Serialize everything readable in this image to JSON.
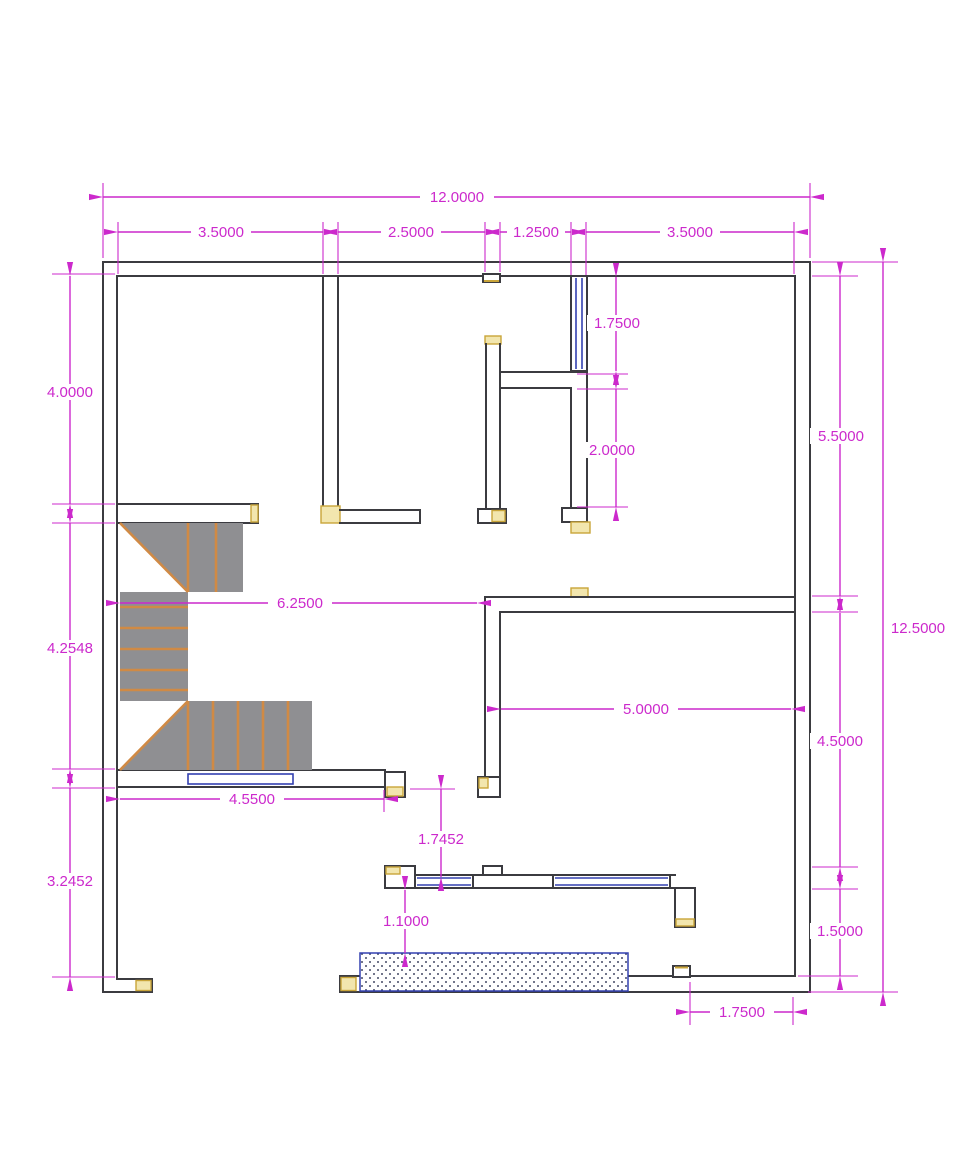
{
  "drawing": {
    "type": "architectural-floor-plan",
    "units_shown": "decimal",
    "colors": {
      "dimension": "#cc29cc",
      "wall": "#3b3b40",
      "stair_fill": "#8f8f92",
      "stair_tread": "#d08a45",
      "window": "#3340b0",
      "door_jamb": "#f2e6ae",
      "background": "#ffffff"
    },
    "dims": {
      "overall_width": "12.0000",
      "top_seg_1": "3.5000",
      "top_seg_2": "2.5000",
      "top_seg_3": "1.2500",
      "top_seg_4": "3.5000",
      "left_upper": "4.0000",
      "left_middle": "4.2548",
      "left_lower": "3.2452",
      "right_upper": "5.5000",
      "overall_height": "12.5000",
      "right_lower": "4.5000",
      "right_bottom": "1.5000",
      "window_height": "1.7500",
      "wall_below_window": "2.0000",
      "hall_width": "6.2500",
      "room_width": "5.0000",
      "stair_width": "4.5500",
      "door_offset": "1.7452",
      "porch_offset": "1.1000",
      "bottom_right_offset": "1.7500"
    }
  }
}
